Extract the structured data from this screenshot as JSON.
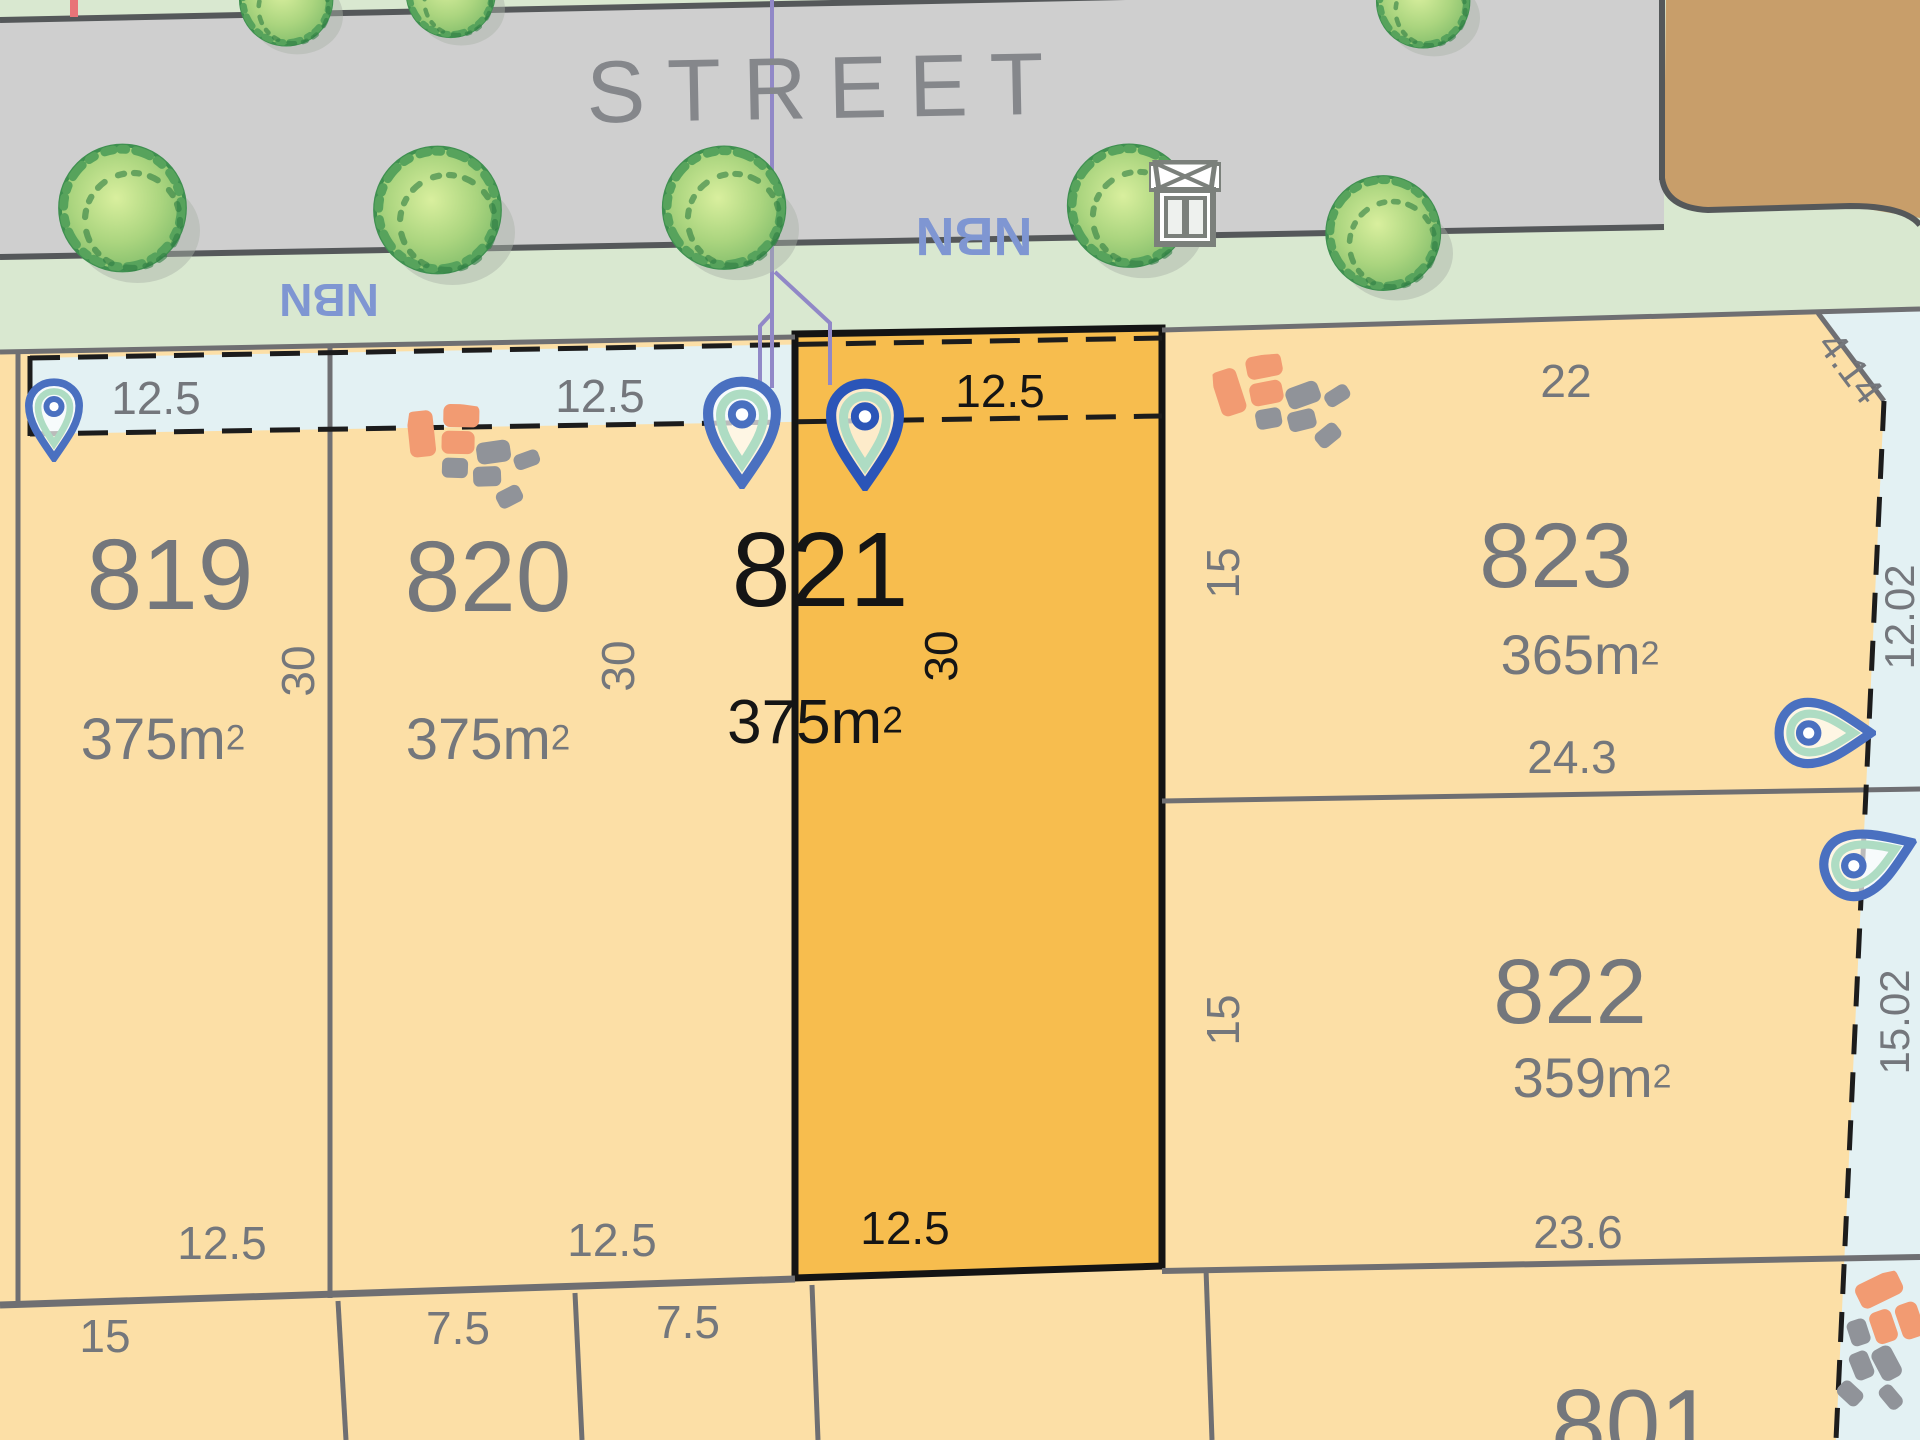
{
  "street": {
    "label": "STREET"
  },
  "utilities": {
    "nbn_left": "NBN",
    "nbn_right": "NBN",
    "nbn_pit_icon": "nbn-pit-icon",
    "power_line_icon": "purple-service-line",
    "pin_icon": "location-pin-icon",
    "crossover_icon": "paver-mosaic-icon"
  },
  "lots": [
    {
      "number": "819",
      "area_base": "375m",
      "area_sup": "2",
      "frontage": "12.5",
      "depth": "30",
      "rear": "12.5"
    },
    {
      "number": "820",
      "area_base": "375m",
      "area_sup": "2",
      "frontage": "12.5",
      "depth": "30",
      "rear": "12.5"
    },
    {
      "number": "821",
      "area_base": "375m",
      "area_sup": "2",
      "frontage": "12.5",
      "depth": "30",
      "rear": "12.5",
      "highlighted": true
    },
    {
      "number": "823",
      "area_base": "365m",
      "area_sup": "2",
      "frontage": "22",
      "side": "15",
      "rear": "24.3",
      "chamfer": "4.14"
    },
    {
      "number": "822",
      "area_base": "359m",
      "area_sup": "2",
      "side": "15",
      "rear": "23.6"
    },
    {
      "number": "801"
    }
  ],
  "right_easement": {
    "dim_top": "12.02",
    "dim_bottom": "15.02"
  },
  "bottom_lots": {
    "dims": [
      "15",
      "7.5",
      "7.5"
    ]
  },
  "colors": {
    "verge": "#d9e8d0",
    "road": "#cfcfcf",
    "road_edge": "#55585a",
    "brown": "#c89e6a",
    "lot_fill": "#fcdfa6",
    "highlight": "#f7bd4e",
    "easement": "#e3f1f3",
    "boundary_gray": "#6f6f72",
    "dash_black": "#1c1c1c",
    "text_gray": "#74777c",
    "nbn_blue": "#7f96d2",
    "purple": "#9188c7",
    "pin_blue": "#4a70c0",
    "pin_blue_dark": "#2b55b8",
    "pin_green": "#aedcc3",
    "tile_orange": "#f29b72",
    "tile_gray": "#909399",
    "red_tick": "#e87478"
  }
}
